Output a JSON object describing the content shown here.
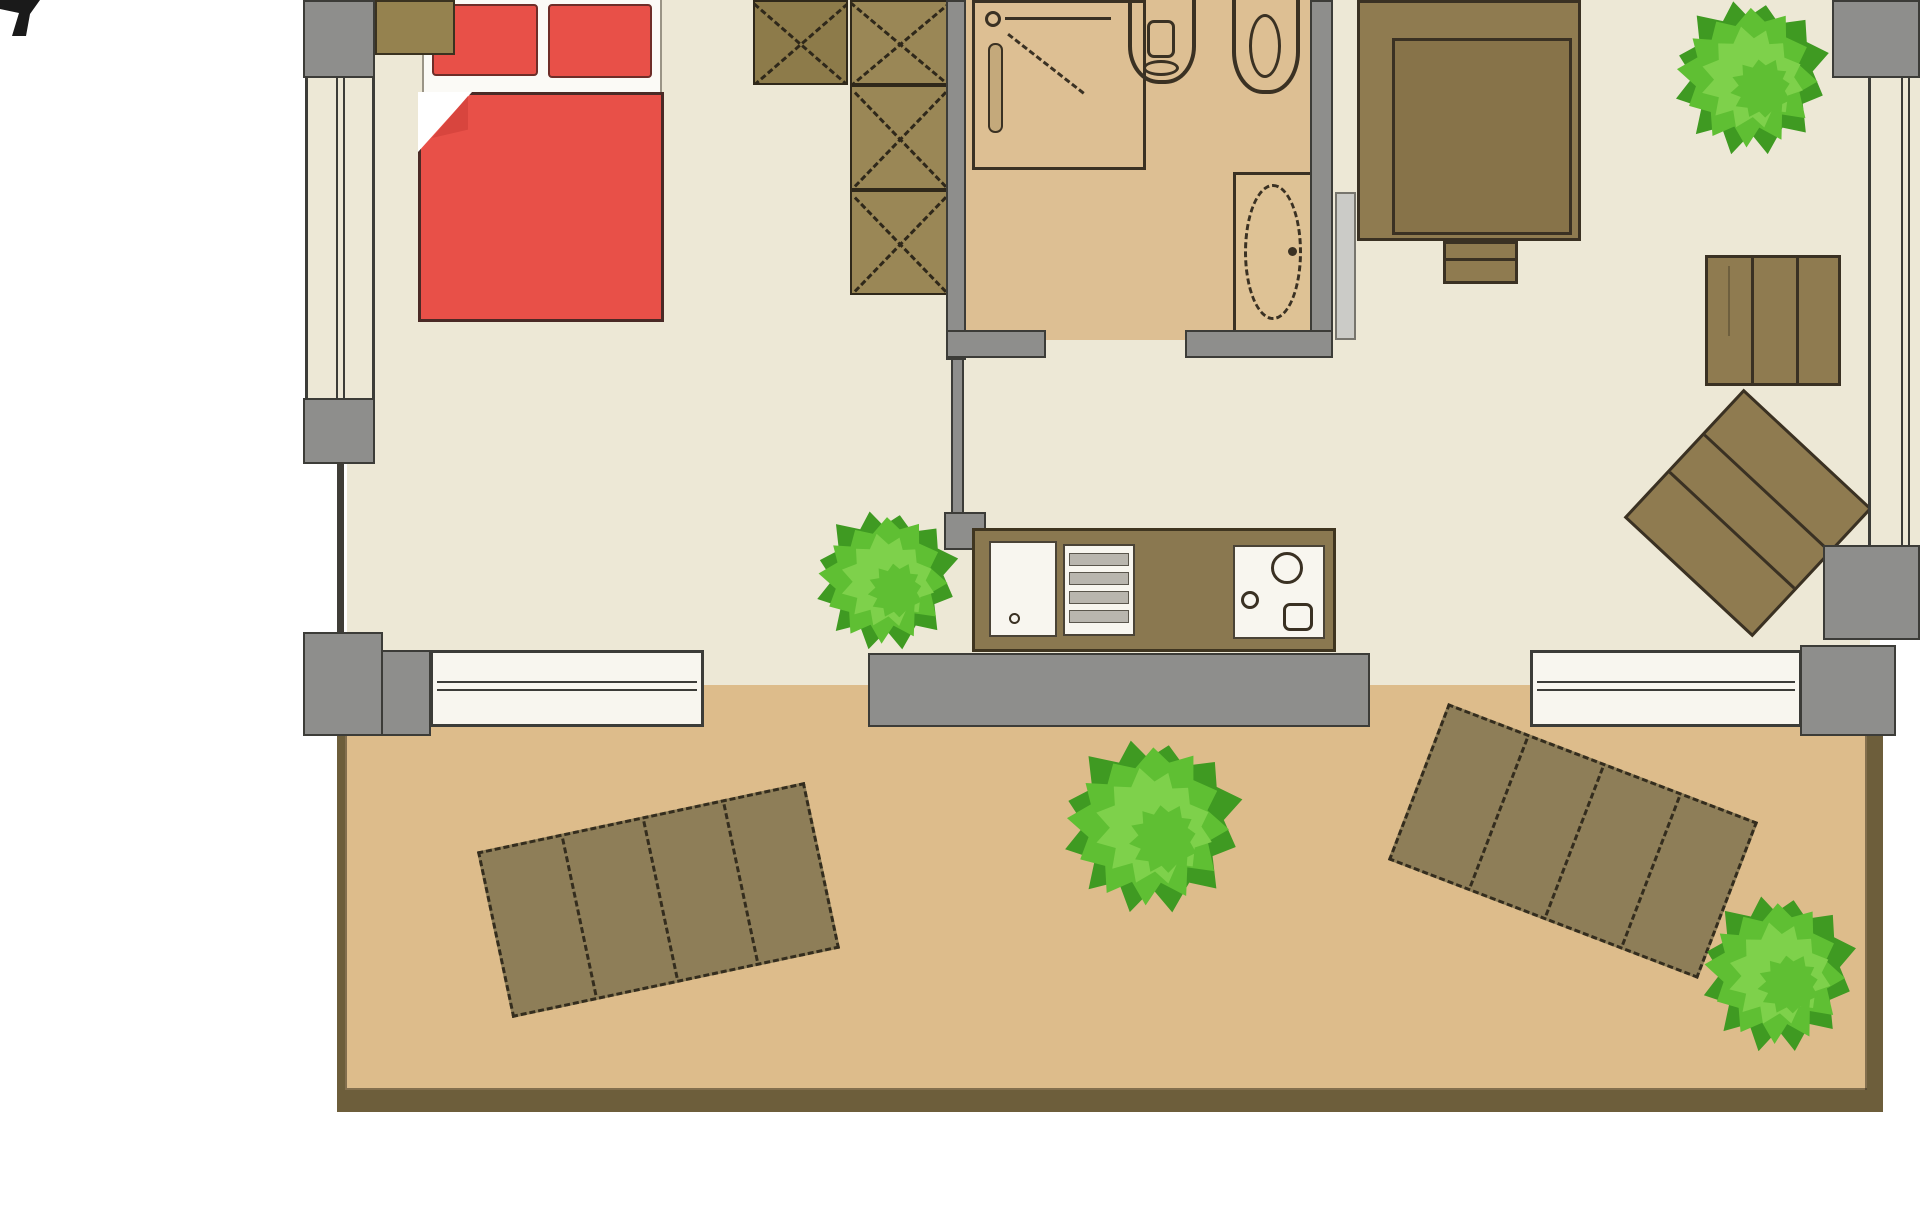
{
  "title": "apartment floor plan (top-down view, cropped at top)",
  "colors": {
    "background": "#FFFFFF",
    "interior_floor": "#EDE8D6",
    "bathroom_floor": "#DDBF93",
    "terrace_floor": "#DDBC8B",
    "terrace_border": "#6D5E3B",
    "wall_gray": "#8E8E8C",
    "wall_outline": "#3C3C38",
    "furniture_brown": "#8F7B50",
    "furniture_brown_dark": "#877349",
    "furniture_outline": "#3A3123",
    "wardrobe_brown": "#9A8756",
    "wardrobe_brown_dark": "#8D7B4A",
    "bed_red": "#E85048",
    "bed_red_dark": "#D8453E",
    "bed_outline": "#4A2A26",
    "window_white": "#F8F6EF",
    "mattress_white": "#FBFAF6",
    "door_leaf_gray": "#CBCBC7",
    "metal_gray": "#B9B6AE",
    "shower_rail_tan": "#C4A97B",
    "plant_dark": "#3F9A22",
    "plant_mid": "#5FBF33",
    "plant_light": "#7ED14B",
    "north_mark": "#1A1A1A"
  },
  "rooms": [
    {
      "id": "bedroom",
      "desc": "bedroom area, cream floor, top left"
    },
    {
      "id": "bathroom",
      "desc": "bathroom, tan floor, top middle"
    },
    {
      "id": "living-area",
      "desc": "living / work area with kitchenette, cream floor, right"
    },
    {
      "id": "terrace",
      "desc": "wood-framed terrace along the bottom"
    }
  ],
  "furniture": [
    {
      "id": "double-bed",
      "desc": "red double bed with two pillows and folded blanket corner"
    },
    {
      "id": "wardrobe",
      "desc": "wardrobe column of crossed (X) storage boxes"
    },
    {
      "id": "shower",
      "desc": "shower stall with shower-head symbol"
    },
    {
      "id": "toilet",
      "desc": "toilet (cut off at top edge)"
    },
    {
      "id": "bidet",
      "desc": "bidet (cut off at top edge)"
    },
    {
      "id": "washbasin",
      "desc": "oval washbasin against bathroom wall"
    },
    {
      "id": "kitchen-counter",
      "desc": "kitchenette: cabinet, drawer grill, counter, double sink with faucet"
    },
    {
      "id": "desk-with-chair",
      "desc": "large desk with chair, top right"
    },
    {
      "id": "cabinet-shelf",
      "desc": "plank cabinet on right wall"
    },
    {
      "id": "side-table",
      "desc": "rotated slatted side table, right"
    },
    {
      "id": "sun-lounger-left",
      "desc": "slatted sun lounger on terrace, tilted left"
    },
    {
      "id": "sun-lounger-right",
      "desc": "slatted sun lounger on terrace, tilted right"
    },
    {
      "id": "plants",
      "desc": "four green bushes / potted plants"
    },
    {
      "id": "north-mark",
      "desc": "black mark fragment, top-left image corner"
    }
  ]
}
